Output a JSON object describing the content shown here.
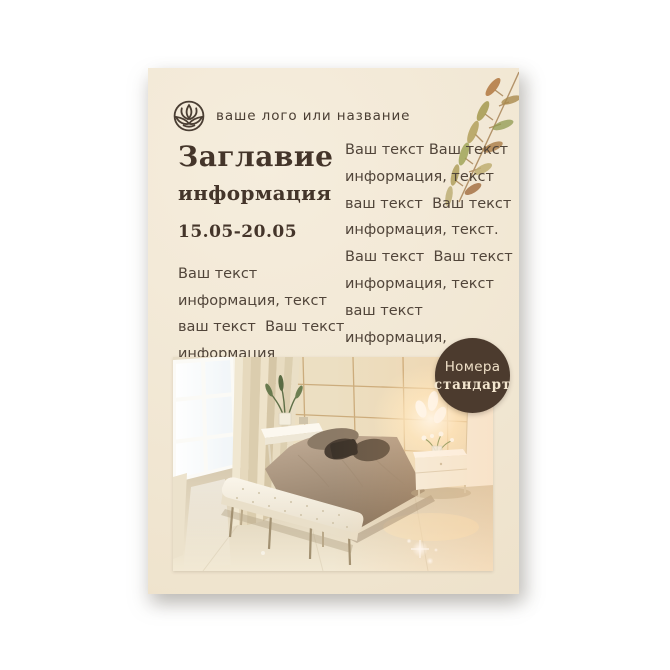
{
  "flyer": {
    "logo": {
      "label": "ваше лого или название",
      "icon": "lotus-circle-icon"
    },
    "title": {
      "line1": "Заглавие",
      "line2": "информация"
    },
    "dates": "15.05-20.05",
    "left_text": [
      "Ваш текст",
      "информация, текст",
      "ваш текст  Ваш текст",
      "информация"
    ],
    "right_text": [
      "Ваш текст Ваш текст",
      "информация, текст",
      "ваш текст  Ваш текст",
      "информация, текст.",
      "Ваш текст  Ваш текст",
      "информация, текст",
      "ваш текст",
      "информация,"
    ],
    "badge": {
      "line1": "Номера",
      "line2": "стандарт"
    },
    "decorations": [
      "watercolor-leaf-branch"
    ],
    "photo": {
      "name": "bedroom-photo",
      "objects": [
        "window",
        "curtains",
        "panel-headboard-wall",
        "lamp-glow",
        "double-bed",
        "pillows",
        "console-table",
        "plant",
        "nightstand",
        "flower-vase",
        "tufted-bench",
        "glossy-floor",
        "light-sparkles"
      ]
    },
    "colors": {
      "page_bg": "#ffffff",
      "card_bg": "#f2e8d5",
      "body_text": "#51453a",
      "heading_text": "#44352a",
      "badge_bg": "#4c3b2e",
      "badge_text": "#f3e6cf"
    }
  }
}
